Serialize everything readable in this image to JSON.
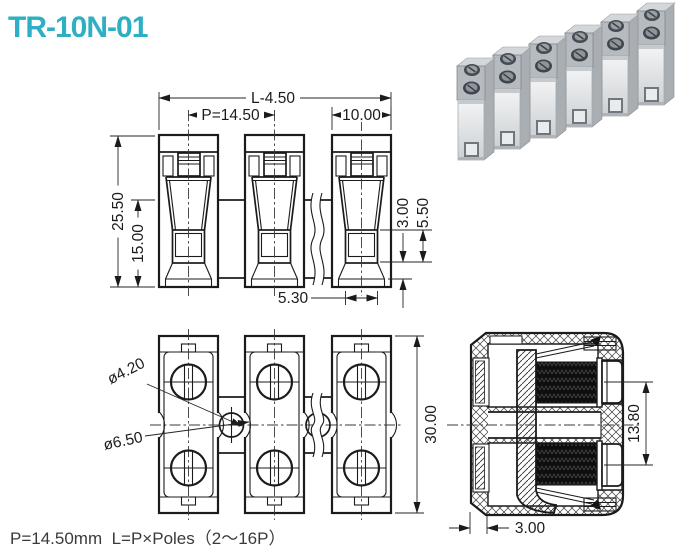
{
  "header": {
    "title": "TR-10N-01",
    "title_color": "#2fafc3"
  },
  "product_photo": {
    "description": "6-pole gray terminal block strip",
    "pole_count": "6"
  },
  "front_view": {
    "overall_length": "L-4.50",
    "pitch": "P=14.50",
    "unit_width": "10.00",
    "overall_height": "25.50",
    "lower_height": "15.00",
    "lead_in_depth": "3.00",
    "wire_slot_height": "5.50",
    "wire_slot_width": "5.30"
  },
  "plan_view": {
    "screw_hole_dia": "ø4.20",
    "mount_hole_dia": "ø6.50",
    "depth": "30.00"
  },
  "section_view": {
    "screw_center_height": "13.80",
    "wall_thickness": "3.00"
  },
  "footer": {
    "note": "P=14.50mm  L=P×Poles（2～16P）"
  }
}
